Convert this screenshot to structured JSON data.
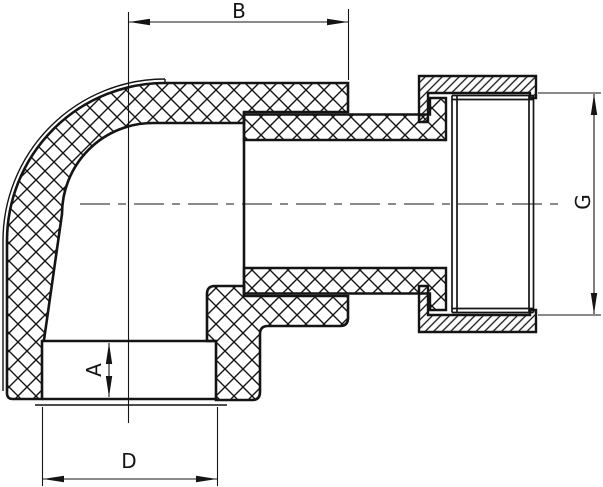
{
  "drawing": {
    "type_note": "cross-section of 90-degree elbow pipe fitting with union nut",
    "labels": {
      "b": "B",
      "a": "A",
      "d": "D",
      "g": "G"
    },
    "colors": {
      "ink": "#141414",
      "paper": "#ffffff"
    }
  }
}
